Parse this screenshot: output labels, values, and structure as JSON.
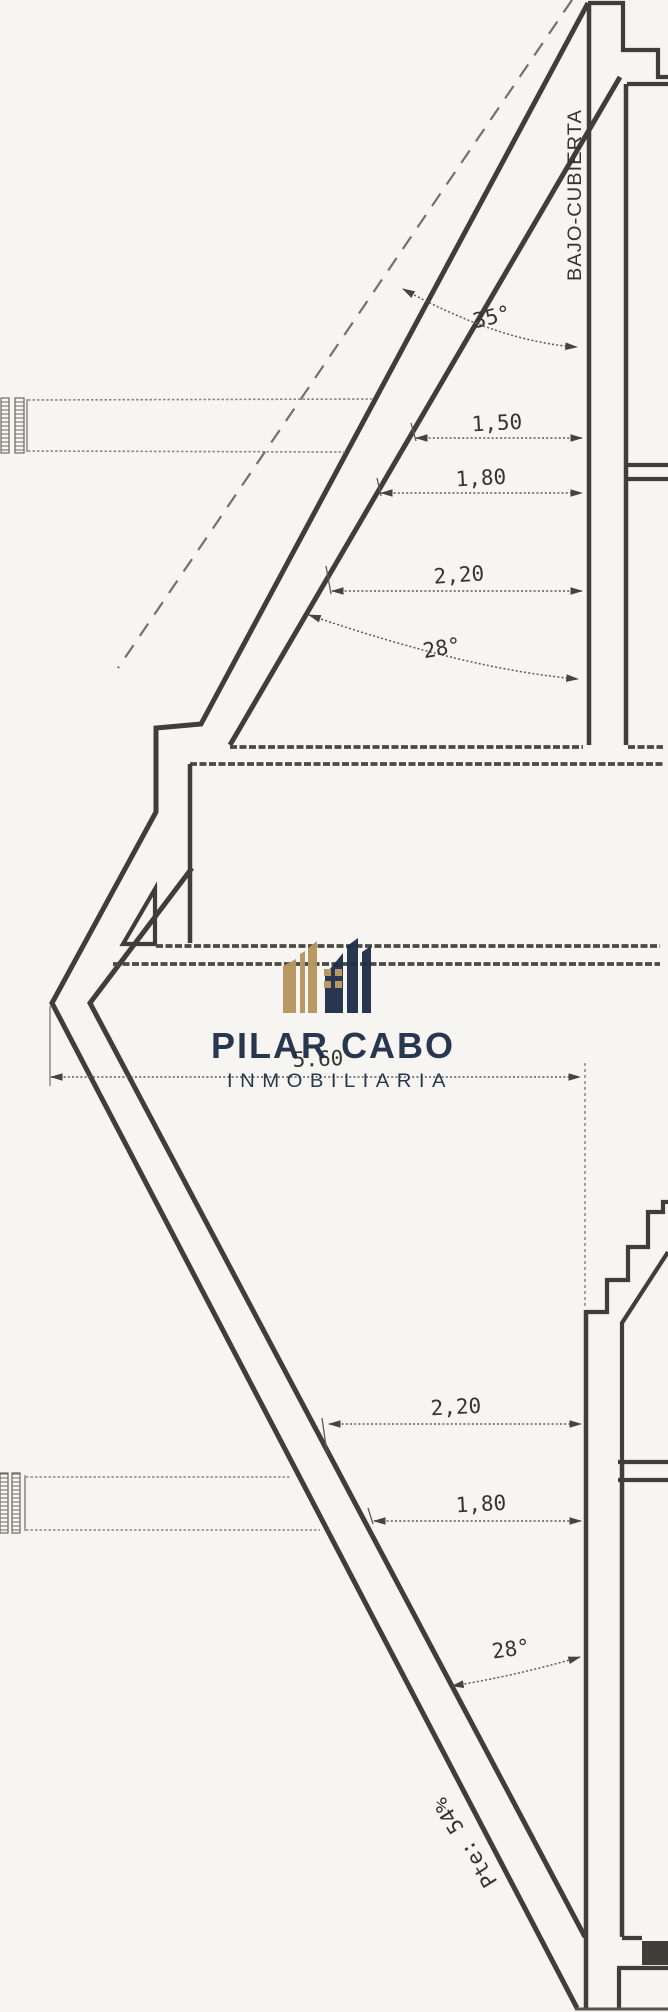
{
  "labels": {
    "room": "BAJO-CUBIERTA"
  },
  "upper_dims": {
    "roof_angle": "35°",
    "d1": "1,50",
    "d2": "1,80",
    "d3": "2,20",
    "ceiling_angle": "28°"
  },
  "plan_width": "5.60",
  "lower_dims": {
    "d1": "2,20",
    "d2": "1,80",
    "angle": "28°",
    "slope": "Pte: 54%"
  },
  "watermark": {
    "title": "PILAR CABO",
    "subtitle": "INMOBILIARIA",
    "colors": {
      "gold": "#b6955c",
      "navy": "#1e2c47"
    }
  }
}
